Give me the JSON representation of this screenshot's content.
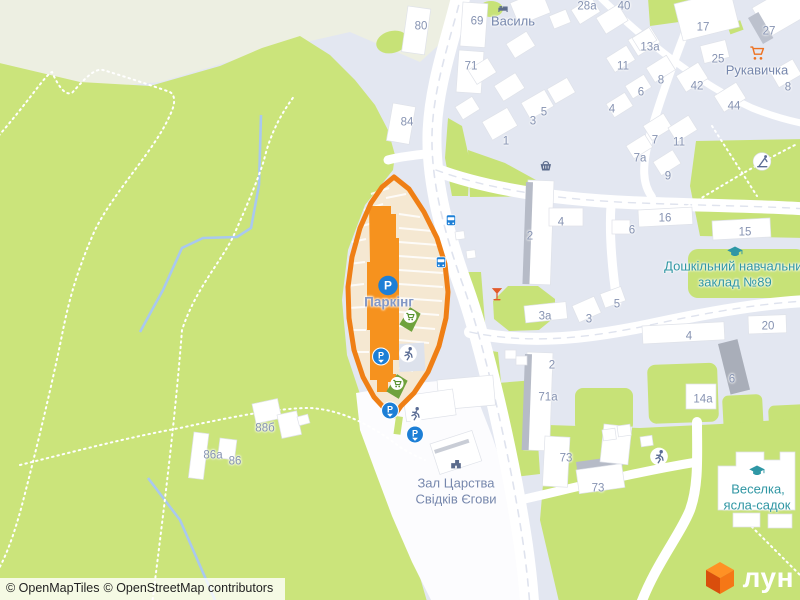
{
  "attribution": {
    "openmaptiles": "© OpenMapTiles",
    "osm": "© OpenStreetMap contributors"
  },
  "logo": {
    "text": "лун"
  },
  "highlight": {
    "name": "Паркінг",
    "outline_color": "#ef7f15",
    "building_color": "#f6921e",
    "lot_color": "#f5e8d2"
  },
  "colors": {
    "park": "#cbe47b",
    "residential": "#e3e7f1",
    "pale_land": "#edefe2",
    "road": "#ffffff",
    "water": "#a9c8ef",
    "poi_blue": "#1d7fd6",
    "pin_green": "#6fa23d",
    "label_gray": "#8693b2",
    "label_teal": "#2f96a3",
    "logo_orange": "#f07316"
  },
  "labels": [
    {
      "text": "80",
      "x": 421,
      "y": 27,
      "kind": "num"
    },
    {
      "text": "69",
      "x": 477,
      "y": 22,
      "kind": "num"
    },
    {
      "text": "71",
      "x": 471,
      "y": 67,
      "kind": "num"
    },
    {
      "text": "Василь",
      "x": 513,
      "y": 21,
      "kind": "poi"
    },
    {
      "text": "28а",
      "x": 587,
      "y": 7,
      "kind": "num"
    },
    {
      "text": "40",
      "x": 624,
      "y": 7,
      "kind": "num"
    },
    {
      "text": "17",
      "x": 703,
      "y": 28,
      "kind": "num"
    },
    {
      "text": "27",
      "x": 769,
      "y": 32,
      "kind": "num"
    },
    {
      "text": "13а",
      "x": 650,
      "y": 48,
      "kind": "num"
    },
    {
      "text": "25",
      "x": 718,
      "y": 60,
      "kind": "num"
    },
    {
      "text": "Рукавичка",
      "x": 757,
      "y": 70,
      "kind": "poi"
    },
    {
      "text": "11",
      "x": 623,
      "y": 67,
      "kind": "num"
    },
    {
      "text": "8",
      "x": 661,
      "y": 81,
      "kind": "num"
    },
    {
      "text": "6",
      "x": 641,
      "y": 93,
      "kind": "num"
    },
    {
      "text": "42",
      "x": 697,
      "y": 87,
      "kind": "num"
    },
    {
      "text": "44",
      "x": 734,
      "y": 107,
      "kind": "num"
    },
    {
      "text": "8",
      "x": 788,
      "y": 88,
      "kind": "num"
    },
    {
      "text": "4",
      "x": 612,
      "y": 110,
      "kind": "num"
    },
    {
      "text": "84",
      "x": 407,
      "y": 123,
      "kind": "num"
    },
    {
      "text": "5",
      "x": 544,
      "y": 113,
      "kind": "num"
    },
    {
      "text": "3",
      "x": 533,
      "y": 122,
      "kind": "num"
    },
    {
      "text": "1",
      "x": 506,
      "y": 142,
      "kind": "num"
    },
    {
      "text": "7",
      "x": 655,
      "y": 141,
      "kind": "num"
    },
    {
      "text": "11",
      "x": 679,
      "y": 143,
      "kind": "num"
    },
    {
      "text": "7а",
      "x": 640,
      "y": 159,
      "kind": "num"
    },
    {
      "text": "9",
      "x": 668,
      "y": 177,
      "kind": "num"
    },
    {
      "text": "16",
      "x": 665,
      "y": 219,
      "kind": "num"
    },
    {
      "text": "6",
      "x": 632,
      "y": 231,
      "kind": "num"
    },
    {
      "text": "15",
      "x": 745,
      "y": 233,
      "kind": "num"
    },
    {
      "text": "2",
      "x": 530,
      "y": 237,
      "kind": "num"
    },
    {
      "text": "4",
      "x": 561,
      "y": 223,
      "kind": "num"
    },
    {
      "text": "Дошкільний навчальний",
      "x": 737,
      "y": 266,
      "kind": "edu"
    },
    {
      "text": "заклад №89",
      "x": 735,
      "y": 282,
      "kind": "edu"
    },
    {
      "text": "Паркінг",
      "x": 389,
      "y": 302,
      "kind": "parking"
    },
    {
      "text": "5",
      "x": 617,
      "y": 305,
      "kind": "num"
    },
    {
      "text": "3а",
      "x": 545,
      "y": 317,
      "kind": "num"
    },
    {
      "text": "3",
      "x": 589,
      "y": 320,
      "kind": "num"
    },
    {
      "text": "20",
      "x": 768,
      "y": 327,
      "kind": "num"
    },
    {
      "text": "4",
      "x": 689,
      "y": 337,
      "kind": "num"
    },
    {
      "text": "2",
      "x": 552,
      "y": 366,
      "kind": "num"
    },
    {
      "text": "6",
      "x": 732,
      "y": 380,
      "kind": "num"
    },
    {
      "text": "71а",
      "x": 548,
      "y": 398,
      "kind": "num"
    },
    {
      "text": "14а",
      "x": 703,
      "y": 400,
      "kind": "num"
    },
    {
      "text": "88б",
      "x": 265,
      "y": 429,
      "kind": "num"
    },
    {
      "text": "86а",
      "x": 213,
      "y": 456,
      "kind": "num"
    },
    {
      "text": "86",
      "x": 235,
      "y": 462,
      "kind": "num"
    },
    {
      "text": "73",
      "x": 566,
      "y": 459,
      "kind": "num"
    },
    {
      "text": "73",
      "x": 598,
      "y": 489,
      "kind": "num"
    },
    {
      "text": "Зал Царства",
      "x": 456,
      "y": 483,
      "kind": "poi"
    },
    {
      "text": "Свідків Єгови",
      "x": 456,
      "y": 499,
      "kind": "poi"
    },
    {
      "text": "Веселка,",
      "x": 758,
      "y": 489,
      "kind": "edu"
    },
    {
      "text": "ясла-садок",
      "x": 757,
      "y": 505,
      "kind": "edu"
    }
  ],
  "pois": [
    {
      "type": "parking",
      "x": 388,
      "y": 288
    },
    {
      "type": "parking-entrance",
      "x": 381,
      "y": 359
    },
    {
      "type": "parking-entrance",
      "x": 390,
      "y": 413
    },
    {
      "type": "parking-entrance",
      "x": 415,
      "y": 437
    },
    {
      "type": "bus-stop",
      "x": 451,
      "y": 223
    },
    {
      "type": "bus-stop",
      "x": 441,
      "y": 265
    },
    {
      "type": "mall-pin",
      "x": 410,
      "y": 322
    },
    {
      "type": "mall-pin",
      "x": 397,
      "y": 389
    },
    {
      "type": "sports",
      "x": 408,
      "y": 356
    },
    {
      "type": "sports",
      "x": 415,
      "y": 416
    },
    {
      "type": "sports",
      "x": 659,
      "y": 459
    },
    {
      "type": "playground",
      "x": 762,
      "y": 164
    },
    {
      "type": "bar",
      "x": 497,
      "y": 296
    },
    {
      "type": "shop-basket",
      "x": 545,
      "y": 167
    },
    {
      "type": "supermarket-cart",
      "x": 757,
      "y": 55
    },
    {
      "type": "hotel",
      "x": 503,
      "y": 9
    },
    {
      "type": "school",
      "x": 735,
      "y": 254
    },
    {
      "type": "school",
      "x": 757,
      "y": 473
    },
    {
      "type": "worship",
      "x": 456,
      "y": 466
    }
  ]
}
